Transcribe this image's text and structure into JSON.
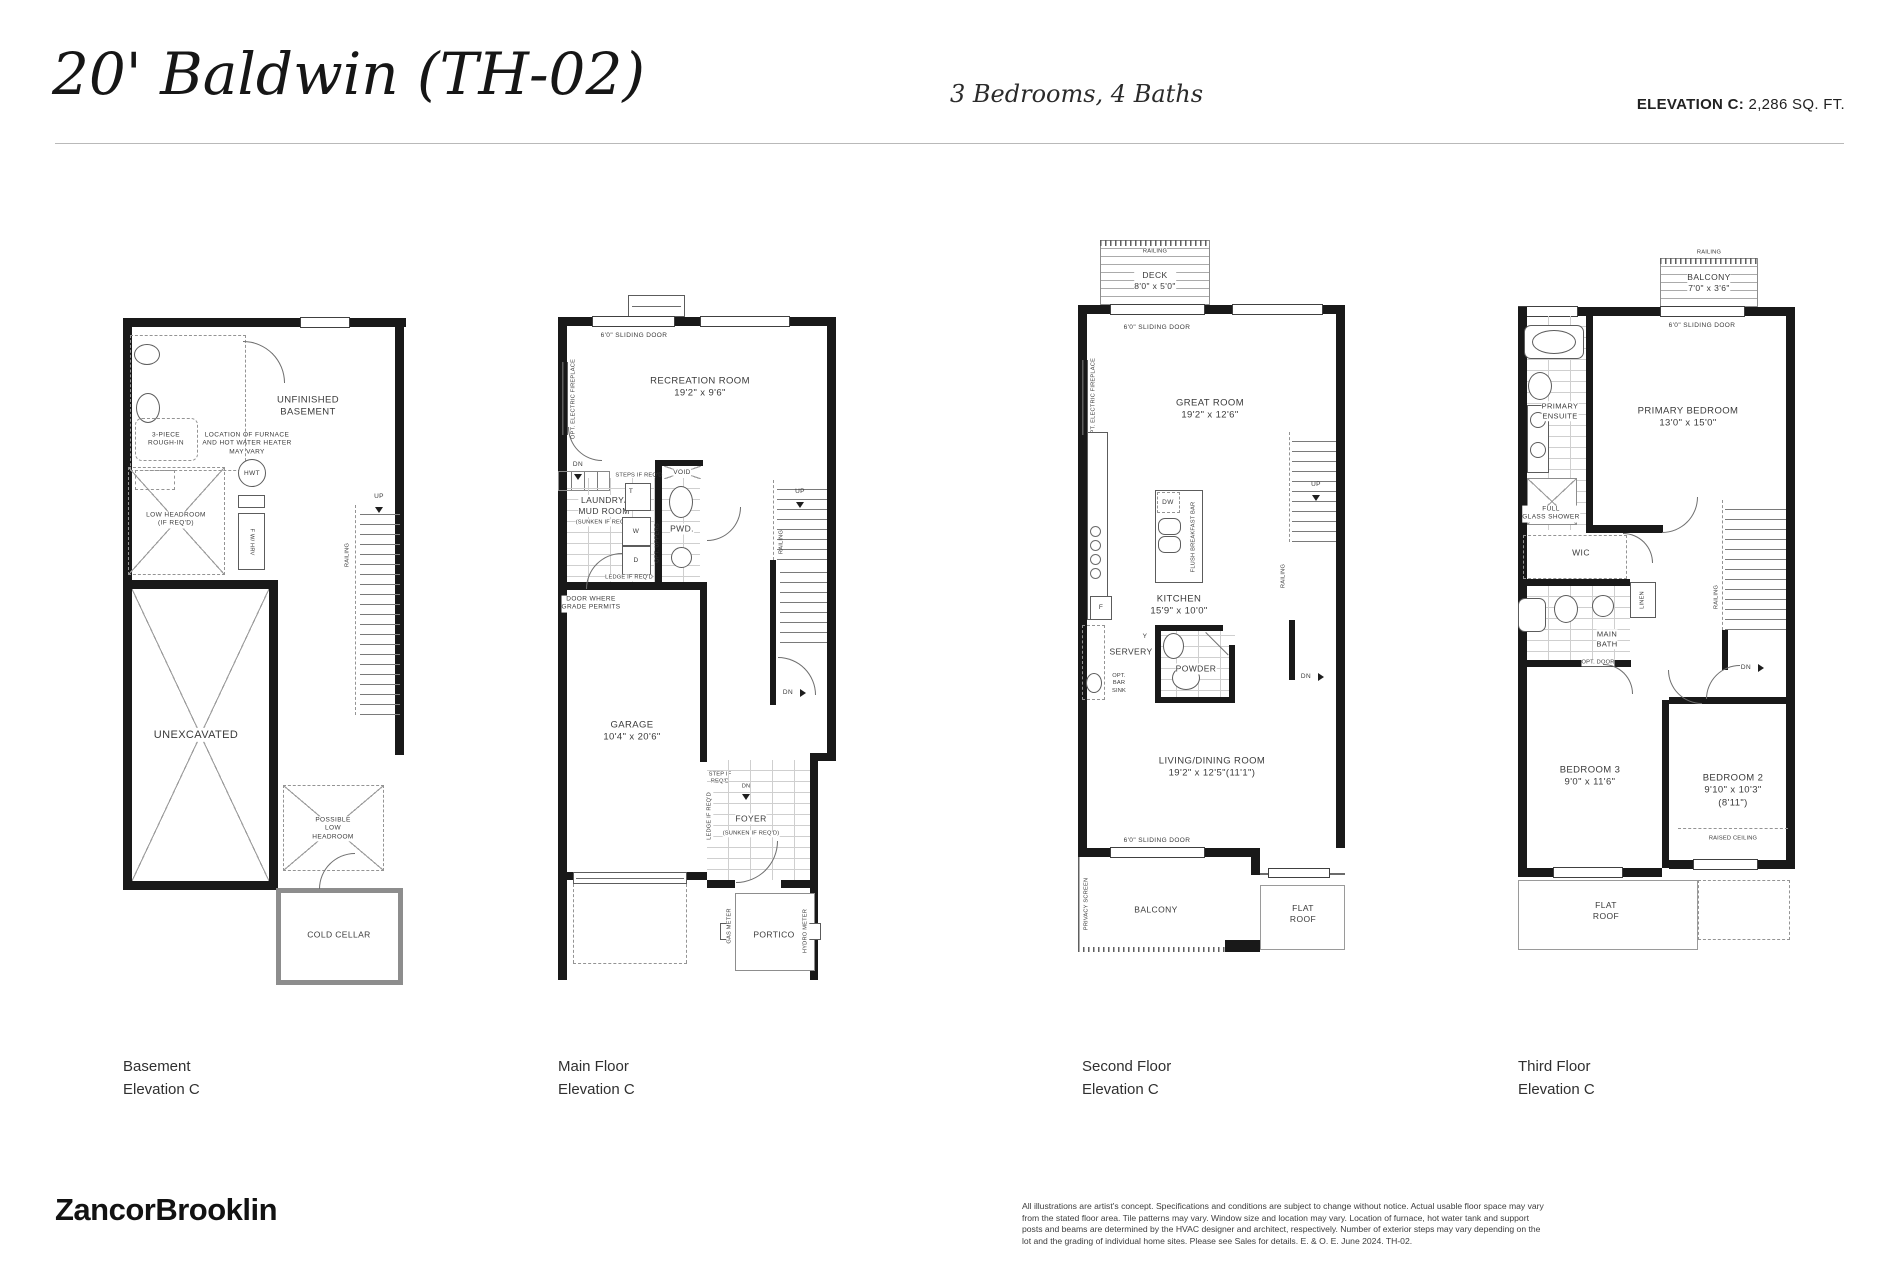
{
  "header": {
    "title": "20' Baldwin (TH-02)",
    "subtitle": "3 Bedrooms, 4 Baths",
    "elevation_label": "ELEVATION C:",
    "elevation_value": "2,286 SQ. FT."
  },
  "common": {
    "railing": "RAILING",
    "up": "UP",
    "dn": "DN",
    "sliding_door": "6'0\" SLIDING DOOR",
    "flat_roof": "FLAT ROOF"
  },
  "basement": {
    "caption": "Basement\nElevation C",
    "unfinished": "UNFINISHED\nBASEMENT",
    "rough_in": "3-PIECE\nROUGH-IN",
    "furnace_note": "LOCATION OF FURNACE\nAND HOT WATER HEATER\nMAY VARY",
    "hwt": "HWT",
    "hrv": "F W/ HRV",
    "low_headroom": "LOW HEADROOM\n(IF REQ'D)",
    "unexcavated": "UNEXCAVATED",
    "possible_low_headroom": "POSSIBLE\nLOW\nHEADROOM",
    "cold_cellar": "COLD CELLAR"
  },
  "main": {
    "caption": "Main Floor\nElevation C",
    "recreation": "RECREATION ROOM\n19'2\" x 9'6\"",
    "opt_fireplace": "OPT. ELECTRIC FIREPLACE",
    "steps_if_reqd": "STEPS IF REQ'D",
    "laundry": "LAUNDRY/\nMUD ROOM",
    "laundry_sunken": "(SUNKEN IF REQ'D)",
    "washer": "W",
    "dryer": "D",
    "tub": "T",
    "opt_uppers": "OPT. UPPERS",
    "void": "VOID",
    "pwd": "PWD.",
    "ledge": "LEDGE IF REQ'D",
    "door_grade": "DOOR WHERE\nGRADE PERMITS",
    "garage": "GARAGE\n10'4\" x 20'6\"",
    "step_if_reqd": "STEP IF\nREQ'D",
    "foyer": "FOYER",
    "foyer_sunken": "(SUNKEN IF REQ'D)",
    "portico": "PORTICO",
    "gas_meter": "GAS METER",
    "hydro_meter": "HYDRO METER"
  },
  "second": {
    "caption": "Second Floor\nElevation C",
    "deck": "DECK\n8'0\" x 5'0\"",
    "great_room": "GREAT ROOM\n19'2\" x 12'6\"",
    "opt_fireplace": "OPT. ELECTRIC FIREPLACE",
    "kitchen": "KITCHEN\n15'9\" x 10'0\"",
    "dw": "DW",
    "fridge": "F",
    "flush_bar": "FLUSH BREAKFAST BAR",
    "servery_y": "Y",
    "servery": "SERVERY",
    "opt_bar_sink": "OPT.\nBAR\nSINK",
    "powder": "POWDER",
    "living": "LIVING/DINING ROOM\n19'2\" x 12'5\"(11'1\")",
    "privacy_screen": "PRIVACY SCREEN",
    "balcony": "BALCONY"
  },
  "third": {
    "caption": "Third Floor\nElevation C",
    "balcony": "BALCONY\n7'0\" x 3'6\"",
    "primary_ensuite": "PRIMARY\nENSUITE",
    "full_glass_shower": "FULL\nGLASS SHOWER",
    "primary_bedroom": "PRIMARY BEDROOM\n13'0\" x 15'0\"",
    "wic": "WIC",
    "linen": "LINEN",
    "main_bath": "MAIN\nBATH",
    "opt_door": "OPT. DOOR",
    "bedroom3": "BEDROOM 3\n9'0\" x 11'6\"",
    "bedroom2": "BEDROOM 2\n9'10\" x 10'3\"(8'11\")",
    "raised_ceiling": "RAISED CEILING",
    "flat_roof": "FLAT\nROOF"
  },
  "footer": {
    "logo": "ZancorBrooklin",
    "disclaimer": "All illustrations are artist's concept. Specifications and conditions are subject to change without notice. Actual usable floor space may vary from the stated floor area. Tile patterns may vary. Window size and location may vary. Location of furnace, hot water tank and support posts and beams are determined by the HVAC designer and architect, respectively. Number of exterior steps may vary depending on the lot and the grading of individual home sites. Please see Sales for details. E. & O. E. June 2024. TH-02."
  }
}
